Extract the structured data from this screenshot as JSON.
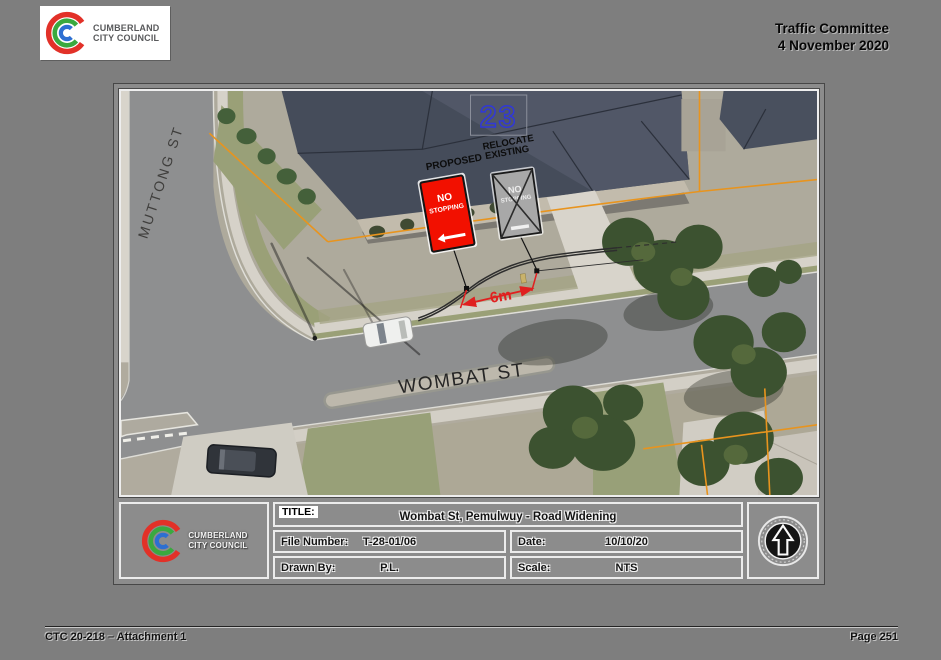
{
  "header": {
    "logo": {
      "line1": "CUMBERLAND",
      "line2": "CITY COUNCIL"
    },
    "committee": "Traffic Committee",
    "meeting_date": "4 November 2020"
  },
  "map": {
    "street_labels": {
      "muttong": "MUTTONG ST",
      "wombat": "WOMBAT ST"
    },
    "house_number": "23",
    "proposed_label": "PROPOSED",
    "relocate_label_line1": "RELOCATE",
    "relocate_label_line2": "EXISTING",
    "proposed_sign": {
      "line1": "NO",
      "line2": "STOPPING"
    },
    "existing_sign": {
      "line1": "NO",
      "line2": "STOPPING"
    },
    "dimension": "6m",
    "colors": {
      "proposed_sign_red": "#f21000",
      "boundary_orange": "#e8941e",
      "dimension_red": "#e02020",
      "house_number_blue": "#3038d8"
    }
  },
  "title_block": {
    "logo": {
      "line1": "CUMBERLAND",
      "line2": "CITY COUNCIL"
    },
    "title_label": "TITLE:",
    "title": "Wombat St, Pemulwuy - Road Widening",
    "file_number_label": "File Number:",
    "file_number": "T-28-01/06",
    "date_label": "Date:",
    "date": "10/10/20",
    "drawn_by_label": "Drawn By:",
    "drawn_by": "P.L.",
    "scale_label": "Scale:",
    "scale": "NTS"
  },
  "footer": {
    "left": "CTC 20-218 – Attachment 1",
    "right": "Page 251"
  }
}
